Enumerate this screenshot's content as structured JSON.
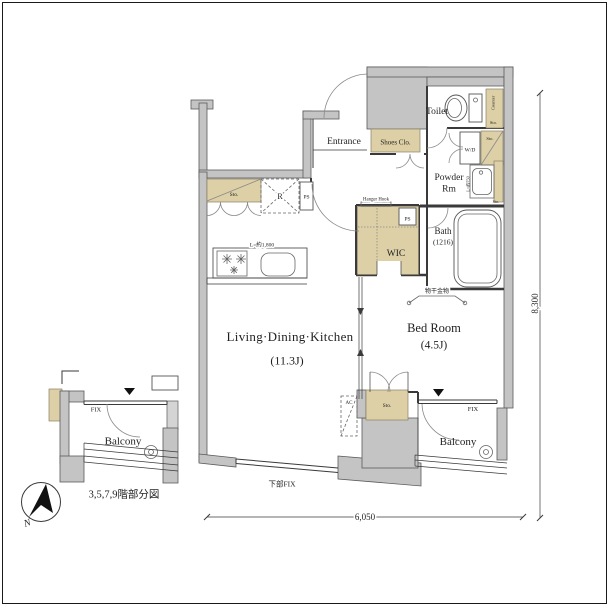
{
  "colors": {
    "background": "#ffffff",
    "wall_fill": "#c4c4c4",
    "wall_fill_light": "#d4d4d4",
    "storage_fill": "#ddd0a6",
    "line": "#3a3a3a",
    "text": "#1f1f1f",
    "border": "#1a1a1a"
  },
  "rooms": {
    "entrance": "Entrance",
    "shoes_closet": "Shoes Clo.",
    "toilet": "Toilet",
    "powder_line1": "Powder",
    "powder_line2": "Rm",
    "bath_line1": "Bath",
    "bath_line2": "(1216)",
    "wic": "WIC",
    "ldk_line1": "Living·Dining·Kitchen",
    "ldk_line2": "(11.3J)",
    "bedroom_line1": "Bed Room",
    "bedroom_line2": "(4.5J)",
    "balcony": "Balcony"
  },
  "fixtures": {
    "storage": "Sto.",
    "washer_dryer": "W/D",
    "refrigerator": "R",
    "pipe_space": "PS",
    "counter": "Counter",
    "air_conditioner": "AC",
    "hanger_hook": "Hanger Hook",
    "laundry_hardware": "物干金物",
    "kitchen_counter_length": "L=約1,800",
    "vanity_width": "L=約750"
  },
  "windows": {
    "fix": "FIX",
    "bottom_fix": "下部FIX"
  },
  "dimensions": {
    "width_mm": "6,050",
    "height_mm": "8,300"
  },
  "annotations": {
    "floor_caption": "3,5,7,9階部分図",
    "north": "N"
  }
}
